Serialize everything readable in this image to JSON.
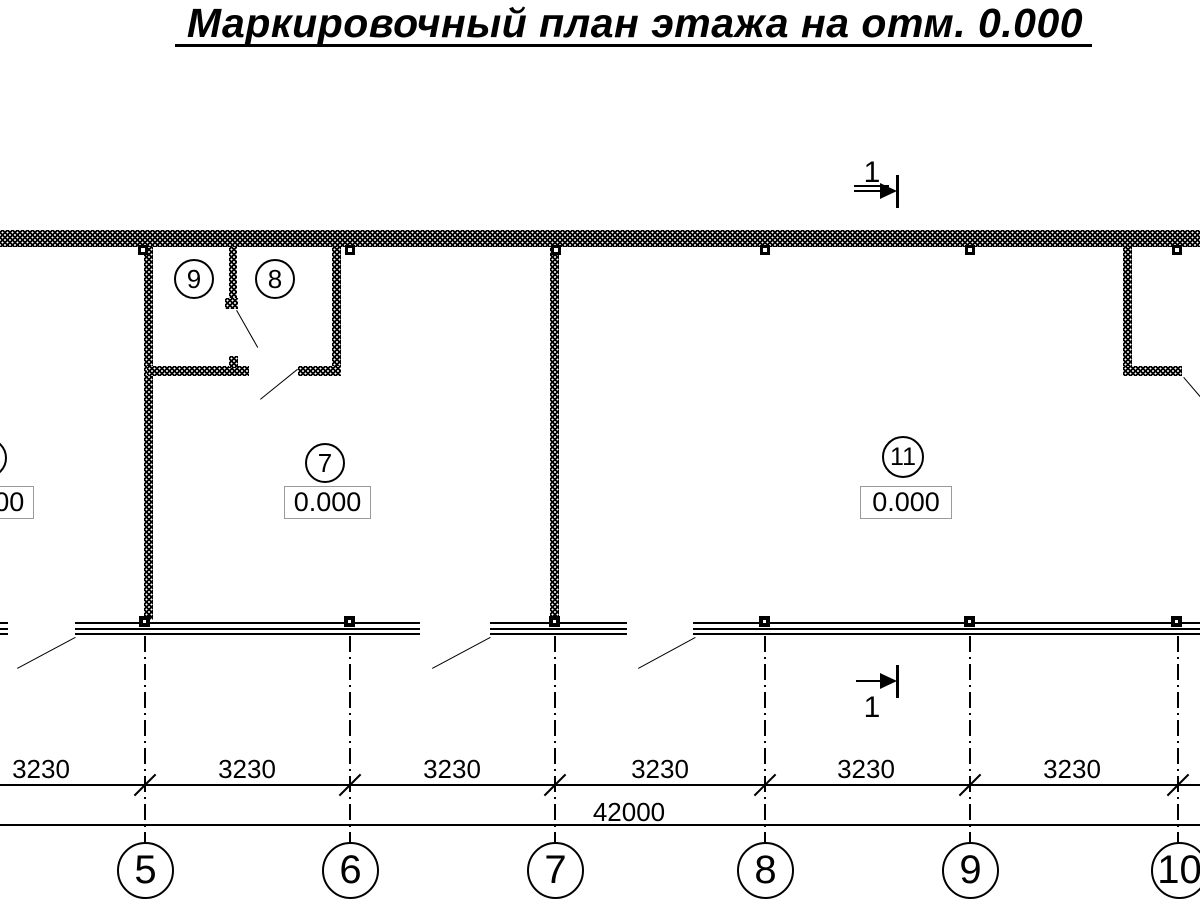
{
  "title": "Маркировочный план этажа на отм. 0.000",
  "section_marks": {
    "top_label": "1",
    "bottom_label": "1"
  },
  "rooms": {
    "left_partial": {
      "number": "",
      "elevation": "0.000"
    },
    "room9": {
      "number": "9"
    },
    "room8": {
      "number": "8"
    },
    "room7": {
      "number": "7",
      "elevation": "0.000"
    },
    "room11": {
      "number": "11",
      "elevation": "0.000"
    }
  },
  "dimensions": {
    "segments": [
      "3230",
      "3230",
      "3230",
      "3230",
      "3230",
      "3230"
    ],
    "total": "42000"
  },
  "axes": {
    "labels": [
      "5",
      "6",
      "7",
      "8",
      "9",
      "10"
    ]
  },
  "colors": {
    "line": "#000000",
    "background": "#ffffff",
    "elevation_box_border": "#9a9a9a"
  }
}
